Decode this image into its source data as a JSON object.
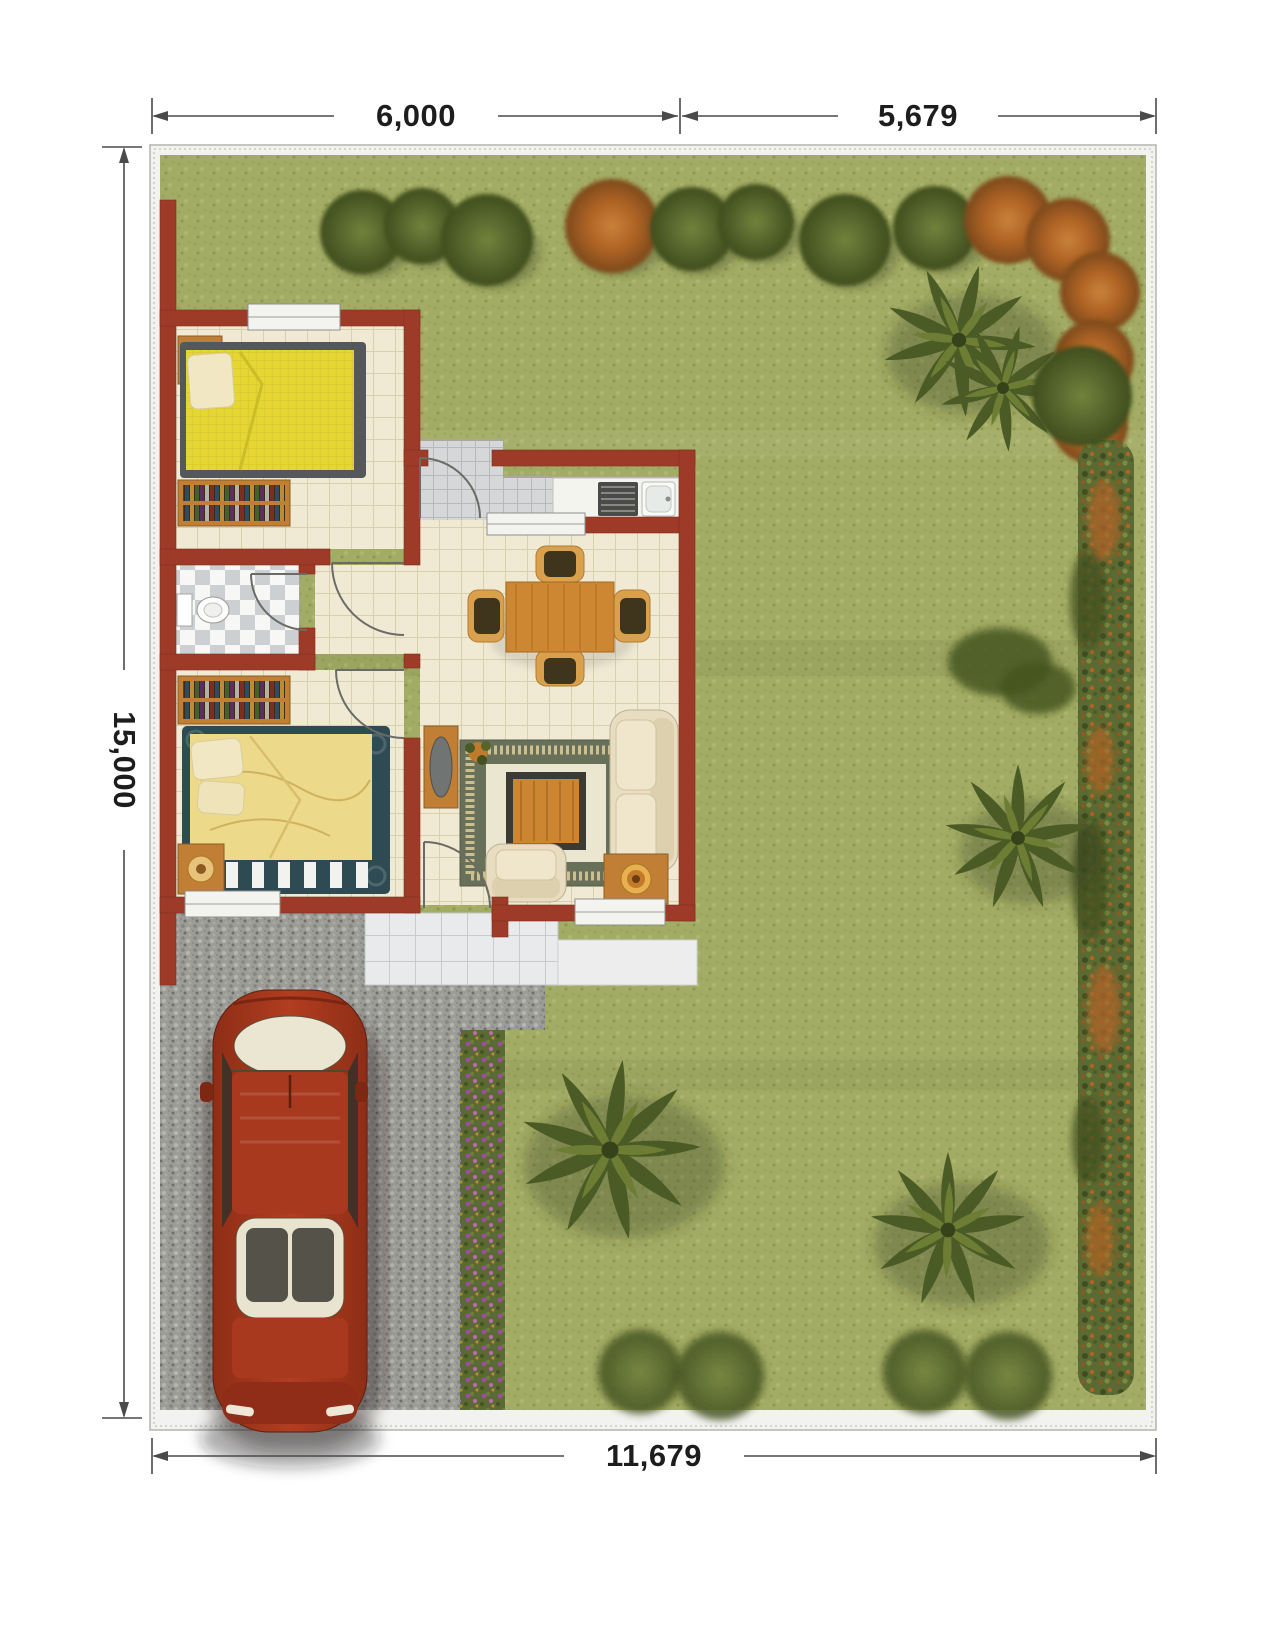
{
  "site_plan": {
    "dimensions": {
      "top_left": "6,000",
      "top_right": "5,679",
      "left": "15,000",
      "bottom": "11,679"
    },
    "colors": {
      "grass": "#a3ac64",
      "wall_red": "#9d3b28",
      "floor_cream": "#f0ead5",
      "tile_gray": "#d5d7d8",
      "gravel_gray": "#9c9c98",
      "car_red": "#a8391e",
      "wood": "#c07f35",
      "rug_olive": "#68705a",
      "tree_green": "#55652c",
      "tree_orange": "#b06425",
      "palm_green": "#4b5b26",
      "flower_purple": "#9a4f9e",
      "bed_yellow": "#e5d634",
      "bed_frame_teal": "#2e4a52",
      "sofa_cream": "#e9ddc1",
      "dimension_line": "#4a4a4a"
    }
  }
}
